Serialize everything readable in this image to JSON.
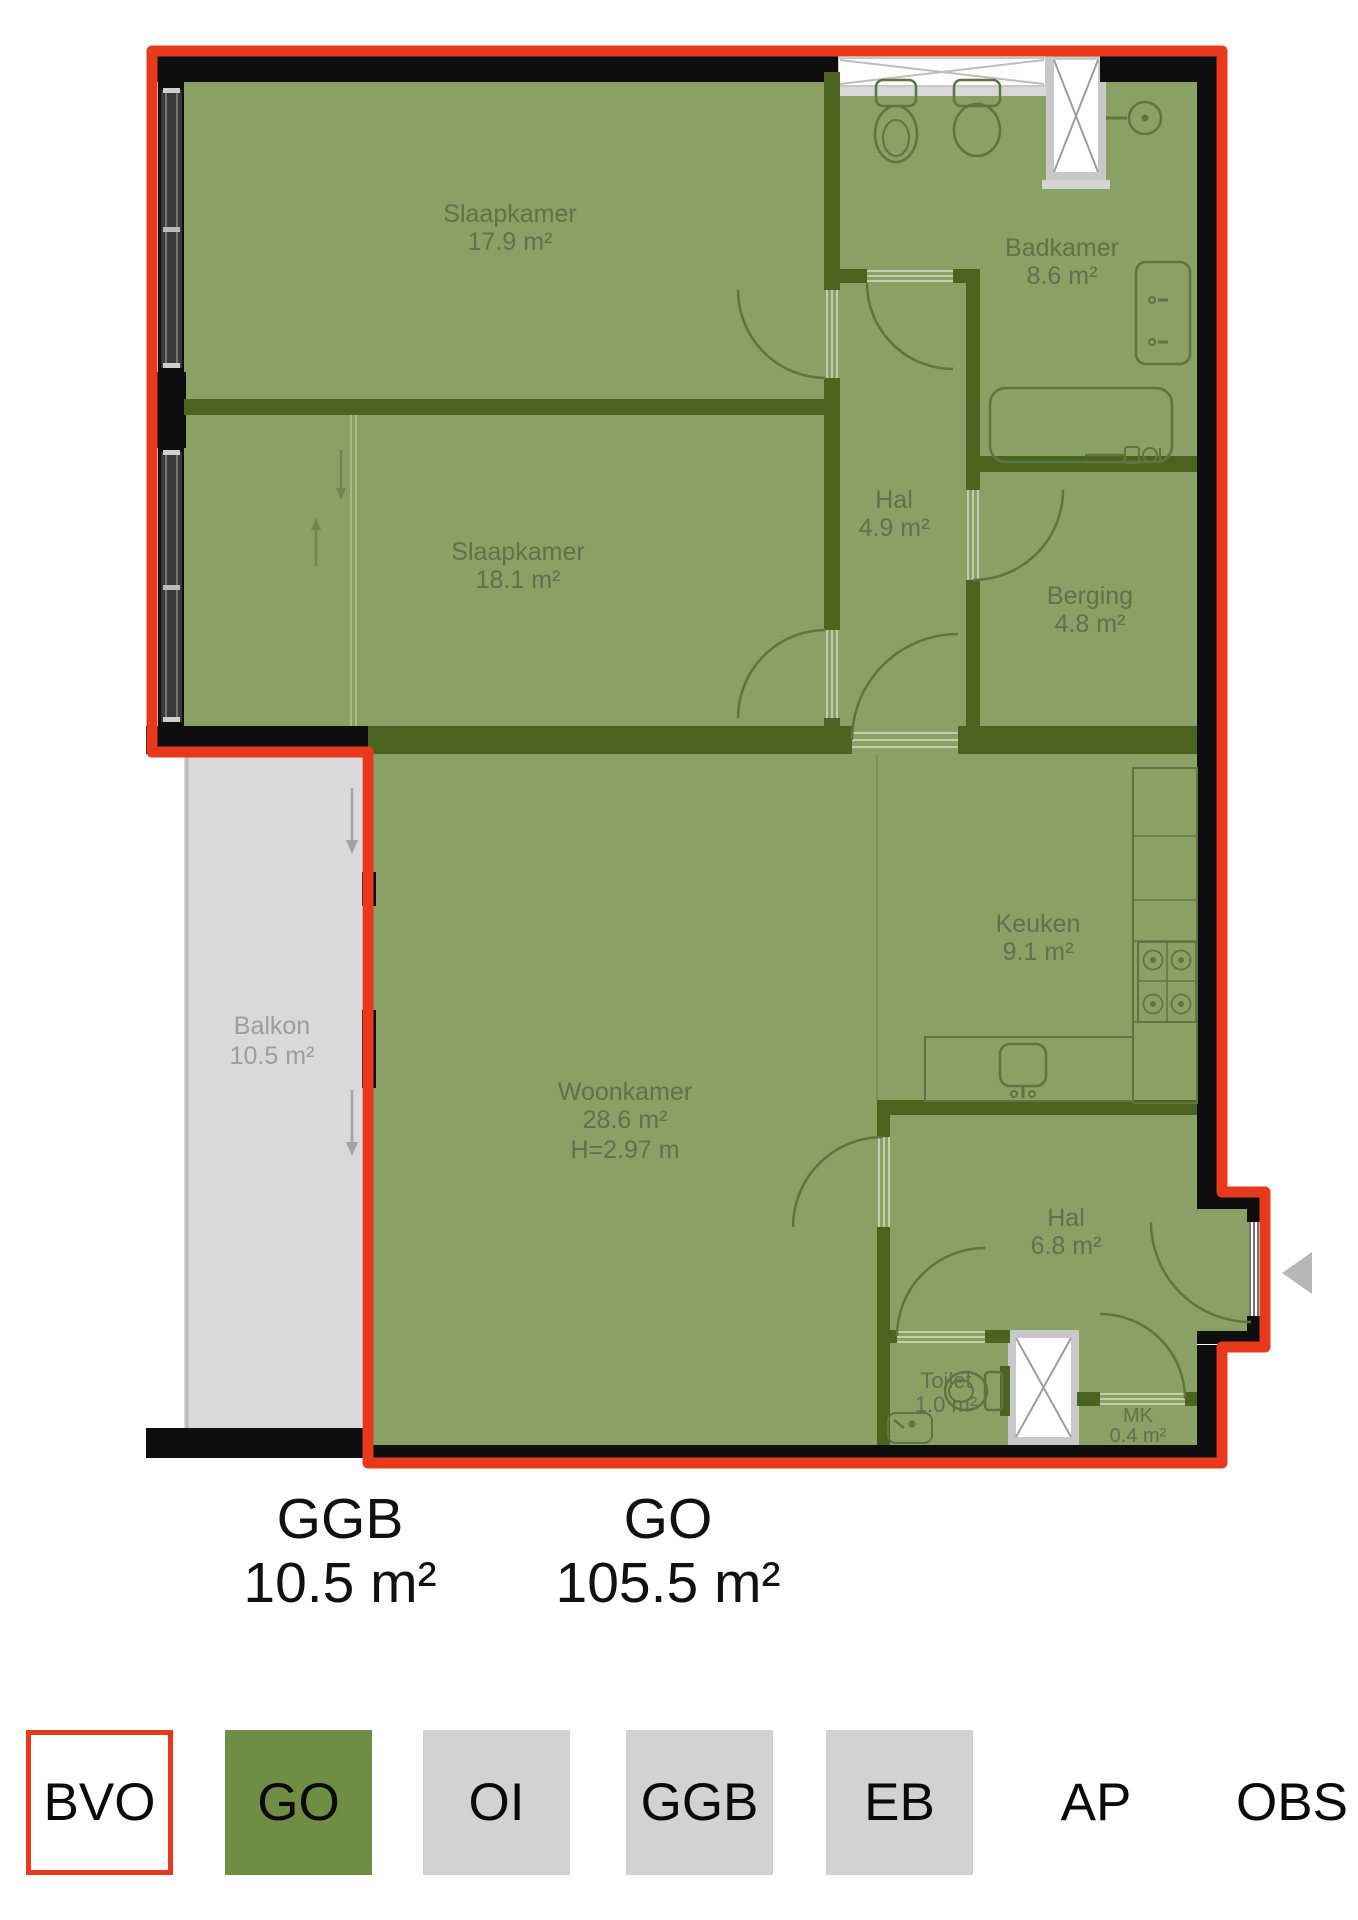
{
  "floorplan": {
    "rooms": [
      {
        "id": "slaapkamer-1",
        "name": "Slaapkamer",
        "area": "17.9 m²"
      },
      {
        "id": "badkamer",
        "name": "Badkamer",
        "area": "8.6 m²"
      },
      {
        "id": "slaapkamer-2",
        "name": "Slaapkamer",
        "area": "18.1 m²"
      },
      {
        "id": "hal-1",
        "name": "Hal",
        "area": "4.9 m²"
      },
      {
        "id": "berging",
        "name": "Berging",
        "area": "4.8 m²"
      },
      {
        "id": "keuken",
        "name": "Keuken",
        "area": "9.1 m²"
      },
      {
        "id": "woonkamer",
        "name": "Woonkamer",
        "area": "28.6 m²",
        "height": "H=2.97 m"
      },
      {
        "id": "balkon",
        "name": "Balkon",
        "area": "10.5 m²"
      },
      {
        "id": "hal-2",
        "name": "Hal",
        "area": "6.8 m²"
      },
      {
        "id": "toilet",
        "name": "Toilet",
        "area": "1.0 m²"
      },
      {
        "id": "mk",
        "name": "MK",
        "area": "0.4 m²"
      }
    ],
    "summary": [
      {
        "label": "GGB",
        "value": "10.5 m²"
      },
      {
        "label": "GO",
        "value": "105.5 m²"
      }
    ],
    "legend": {
      "items": [
        {
          "label": "BVO",
          "swatch": "outline-red"
        },
        {
          "label": "GO",
          "swatch": "green"
        },
        {
          "label": "OI",
          "swatch": "gray"
        },
        {
          "label": "GGB",
          "swatch": "gray"
        },
        {
          "label": "EB",
          "swatch": "gray"
        },
        {
          "label": "AP",
          "swatch": "none"
        },
        {
          "label": "OBS",
          "swatch": "none"
        }
      ]
    },
    "icons": [
      "entrance-arrow-icon",
      "down-arrow-icon",
      "up-arrow-icon",
      "shaft-x-icon",
      "toilet-icon",
      "bidet-icon",
      "shower-icon",
      "bathtub-icon",
      "washbasin-icon",
      "stove-icon",
      "kitchen-sink-icon",
      "window-icon",
      "door-arc-icon"
    ],
    "colors": {
      "bvo_outline": "#e8391d",
      "go_fill": "#6f8e44",
      "room_fill": "#8ba065",
      "wall_interior": "#4a6420",
      "wall_exterior": "#0e0e0e",
      "gray_fill": "#d2d2d2",
      "balcony_fill": "#d9d9d9"
    }
  }
}
